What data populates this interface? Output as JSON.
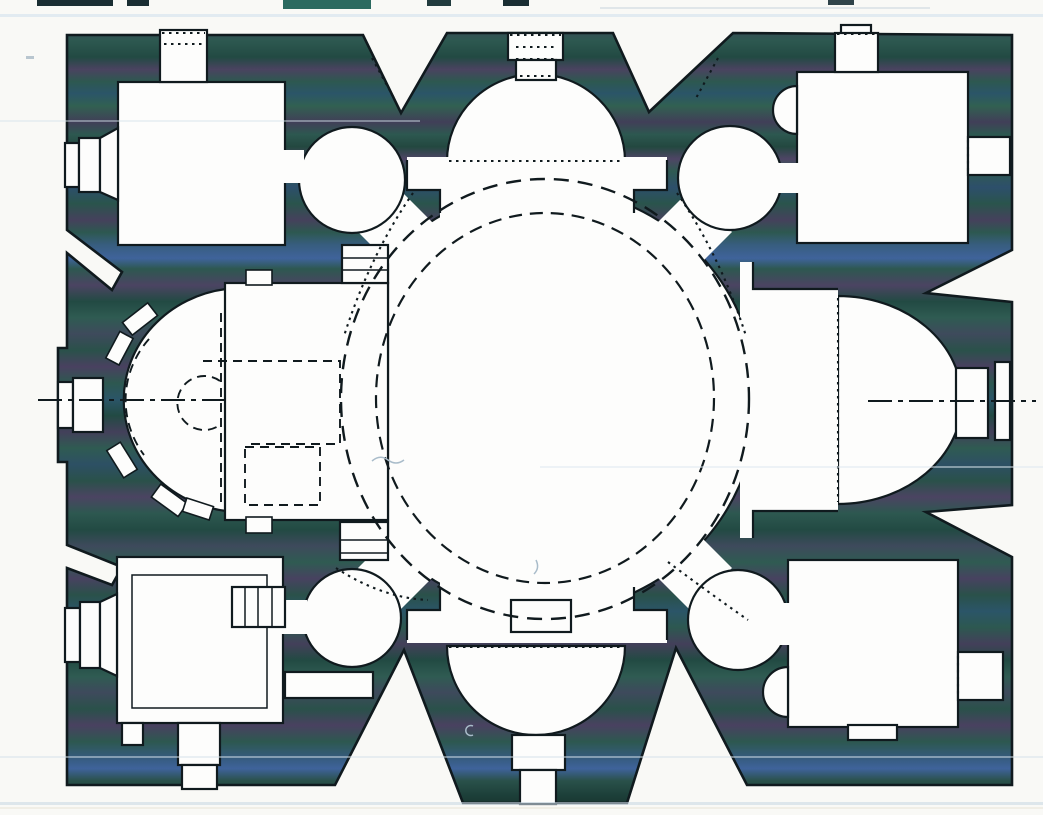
{
  "document": {
    "kind": "scanned architectural drawing",
    "subject": "ground plan of a domed church with central rotunda",
    "visible_text": []
  },
  "palette": {
    "paper": "#f9f9f6",
    "room_fill": "#fdfdfc",
    "ink_line": "#101a1e",
    "artifact_line": "#a9bcca",
    "streak_blue": "#cfe0ec",
    "top_fragment_dark": "#1a2e33",
    "top_fragment_teal": "#2b6a60",
    "wall_bands": [
      [
        0.0,
        "#17332f"
      ],
      [
        0.01,
        "#2a5149"
      ],
      [
        0.03,
        "#3c485a"
      ],
      [
        0.05,
        "#2d5850"
      ],
      [
        0.07,
        "#224a43"
      ],
      [
        0.085,
        "#4a4360"
      ],
      [
        0.1,
        "#2d5850"
      ],
      [
        0.115,
        "#2b5568"
      ],
      [
        0.13,
        "#316051"
      ],
      [
        0.15,
        "#413f58"
      ],
      [
        0.165,
        "#2d5850"
      ],
      [
        0.18,
        "#234840"
      ],
      [
        0.195,
        "#4e4565"
      ],
      [
        0.21,
        "#2f5b52"
      ],
      [
        0.23,
        "#2d4f6b"
      ],
      [
        0.25,
        "#2a544c"
      ],
      [
        0.27,
        "#45415c"
      ],
      [
        0.285,
        "#2d5850"
      ],
      [
        0.3,
        "#375d7e"
      ],
      [
        0.317,
        "#3f639b"
      ],
      [
        0.33,
        "#2d5850"
      ],
      [
        0.35,
        "#4b4462"
      ],
      [
        0.37,
        "#224a43"
      ],
      [
        0.39,
        "#2f5b52"
      ],
      [
        0.41,
        "#3e4a5c"
      ],
      [
        0.43,
        "#2a514a"
      ],
      [
        0.45,
        "#494160"
      ],
      [
        0.47,
        "#2d5850"
      ],
      [
        0.49,
        "#2b5568"
      ],
      [
        0.51,
        "#224a43"
      ],
      [
        0.53,
        "#43405a"
      ],
      [
        0.55,
        "#2f5b52"
      ],
      [
        0.57,
        "#2d5064"
      ],
      [
        0.59,
        "#2a514a"
      ],
      [
        0.61,
        "#4b4462"
      ],
      [
        0.63,
        "#2d5850"
      ],
      [
        0.65,
        "#224a43"
      ],
      [
        0.67,
        "#3e4a5c"
      ],
      [
        0.69,
        "#2f5b52"
      ],
      [
        0.71,
        "#474260"
      ],
      [
        0.73,
        "#2a514a"
      ],
      [
        0.75,
        "#2b5568"
      ],
      [
        0.77,
        "#2d5850"
      ],
      [
        0.79,
        "#43405a"
      ],
      [
        0.81,
        "#224a43"
      ],
      [
        0.83,
        "#2f5b52"
      ],
      [
        0.85,
        "#3e4a5c"
      ],
      [
        0.87,
        "#2a514a"
      ],
      [
        0.89,
        "#494160"
      ],
      [
        0.91,
        "#2d5850"
      ],
      [
        0.93,
        "#355b7e"
      ],
      [
        0.943,
        "#3f639b"
      ],
      [
        0.958,
        "#2a514a"
      ],
      [
        0.975,
        "#1d403a"
      ],
      [
        1.0,
        "#142b27"
      ]
    ]
  },
  "plan_inventory": {
    "central_space": "rotunda with two concentric dashed dome rings and flat west chord",
    "conches": [
      "north conch with dotted chord",
      "south conch with dotted chord"
    ],
    "apses": [
      "west apse with window niches, dashed horseshoe and dashed chancel rectangles",
      "east apse with dotted chord"
    ],
    "corner_rooms": [
      "northwest room",
      "northeast room with wall niche",
      "southwest room with inner square and stair",
      "southeast room with wall niche"
    ],
    "corner_chambers": [
      "NW circular chamber",
      "NE circular chamber",
      "SW circular chamber",
      "SE circular chamber"
    ],
    "fixtures": [
      "altar slab south of centre",
      "two stair ladders on west chord",
      "stair ladder in southwest room",
      "south corridor from southwest room"
    ],
    "axes": [
      "horizontal dash-dot axis west segment",
      "horizontal dash-dot axis east segment"
    ],
    "doorways": [
      "north axial door",
      "south axial door",
      "west axial door",
      "east axial door",
      "NW room north and west doors",
      "NE room north and east doors",
      "SW room west and two south doors",
      "SE room east and south doors"
    ]
  }
}
